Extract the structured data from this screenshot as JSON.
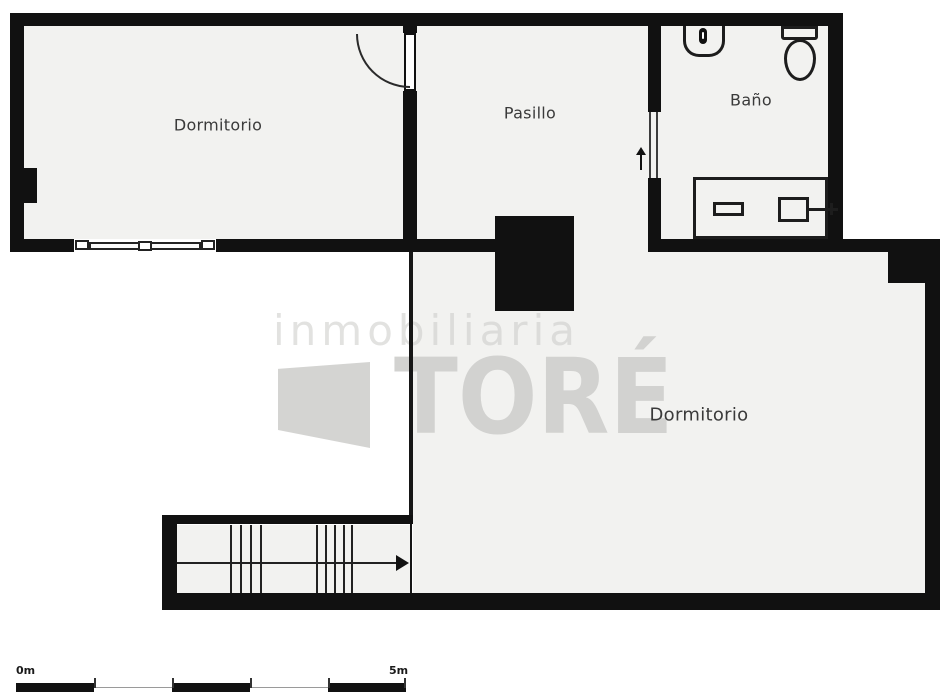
{
  "plan": {
    "rooms": [
      {
        "name": "dormitorio-1",
        "label": "Dormitorio"
      },
      {
        "name": "pasillo",
        "label": "Pasillo"
      },
      {
        "name": "bano",
        "label": "Baño"
      },
      {
        "name": "dormitorio-2",
        "label": "Dormitorio"
      }
    ],
    "watermark": {
      "line1": "inmobiliaria",
      "line2": "TORÉ"
    },
    "scale_bar": {
      "start": "0m",
      "end": "5m"
    },
    "fixtures": [
      "sink-icon",
      "toilet-icon",
      "bathtub-icon",
      "window-icon",
      "door-swing-icon",
      "pocket-door-icon",
      "entry-arrow-icon",
      "staircase-icon",
      "stairs-direction-arrow-icon",
      "chimney-column"
    ],
    "colors": {
      "wall": "#111111",
      "room_fill": "#f2f2f0",
      "background": "#ffffff",
      "watermark": "#d2d2d0",
      "label": "#3a3a3a"
    }
  }
}
